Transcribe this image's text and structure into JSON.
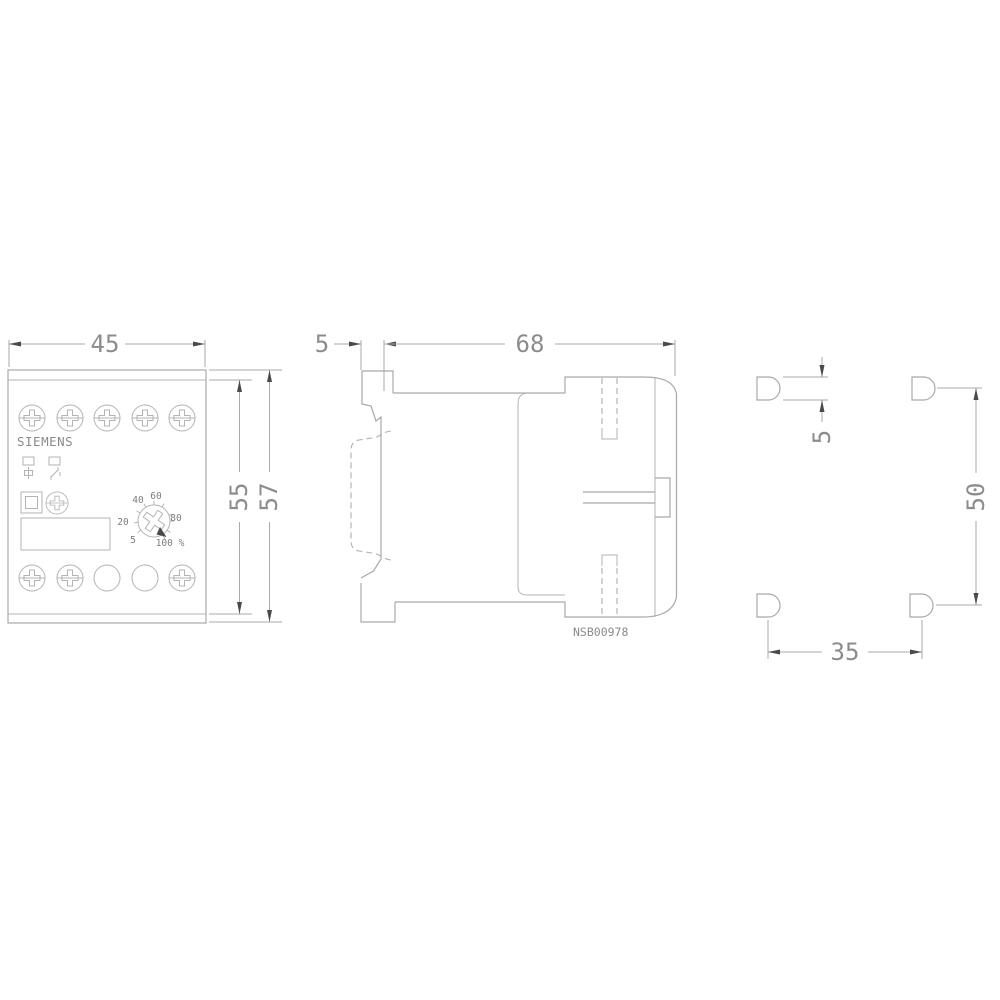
{
  "front_view": {
    "brand": "SIEMENS",
    "dim_width": "45",
    "dim_height_inner": "55",
    "dim_height_outer": "57",
    "dial": {
      "l5": "5",
      "l20": "20",
      "l40": "40",
      "l60": "60",
      "l80": "80",
      "l100": "100 %"
    }
  },
  "side_view": {
    "dim_rail_depth": "5",
    "dim_depth": "68",
    "ref_number": "NSB00978"
  },
  "holes_view": {
    "dim_hole_height": "5",
    "dim_vertical_spacing": "50",
    "dim_horizontal_spacing": "35"
  },
  "colors": {
    "background": "#ffffff",
    "line": "#a9a9a9",
    "text": "#8c8c8c",
    "arrow": "#4a4a4a"
  }
}
